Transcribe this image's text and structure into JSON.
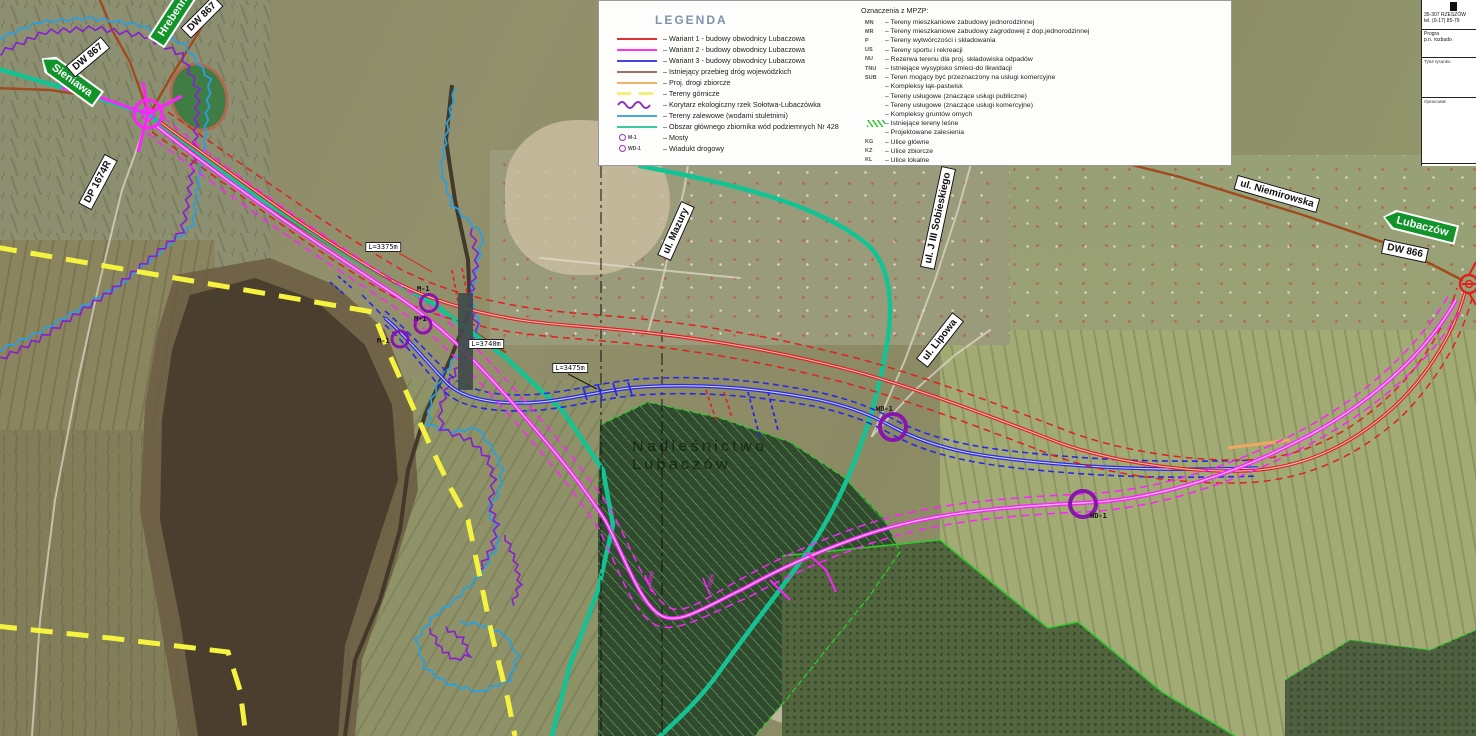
{
  "legend": {
    "title": "LEGENDA",
    "items": [
      {
        "swatch": "line",
        "color": "#e03030",
        "label": "Wariant 1 - budowy obwodnicy Lubaczowa"
      },
      {
        "swatch": "line",
        "color": "#ff30ff",
        "label": "Wariant 2 - budowy obwodnicy Lubaczowa"
      },
      {
        "swatch": "line",
        "color": "#4444e8",
        "label": "Wariant 3 - budowy obwodnicy Lubaczowa"
      },
      {
        "swatch": "line",
        "color": "#9a7263",
        "label": "Istniejący przebieg dróg wojewódzkich"
      },
      {
        "swatch": "line",
        "color": "#eeb268",
        "label": "Proj. drogi zbiorcze"
      },
      {
        "swatch": "dashes",
        "color": "#f4ef7a",
        "label": "Tereny górnicze"
      },
      {
        "swatch": "wavy",
        "color": "#8a2fc9",
        "label": "Korytarz ekologiczny rzek Sołotwa-Lubaczówka"
      },
      {
        "swatch": "line",
        "color": "#49a8de",
        "label": "Tereny zalewowe (wodami stuletnimi)"
      },
      {
        "swatch": "line",
        "color": "#3fc9a1",
        "label": "Obszar głównego zbiornika wód podziemnych Nr 428"
      },
      {
        "swatch": "circle",
        "color": "#9b30c0",
        "code": "M-1",
        "label": "Mosty"
      },
      {
        "swatch": "circle",
        "color": "#9b30c0",
        "code": "WD-1",
        "label": "Wiadukt drogowy"
      }
    ],
    "mpzp": {
      "title": "Oznaczenia z MPZP:",
      "items": [
        {
          "code": "MN",
          "label": "Tereny mieszkaniowe zabudowy jednorodzinnej"
        },
        {
          "code": "MR",
          "label": "Tereny mieszkaniowe zabudowy zagrodowej z dop.jednorodzinnej"
        },
        {
          "code": "P",
          "label": "Tereny wytwórczości i składowania"
        },
        {
          "code": "US",
          "label": "Tereny sportu i rekreacji"
        },
        {
          "code": "NU",
          "label": "Rezerwa terenu dla proj. składowiska odpadów"
        },
        {
          "code": "TNU",
          "label": "Istniejące wysypisko śmieci-do likwidacji"
        },
        {
          "code": "SUB",
          "label": "Teren mogący być przeznaczony na usługi komercyjne"
        },
        {
          "code": "",
          "label": "Kompleksy łąk-pastwisk"
        },
        {
          "code": "",
          "label": "Tereny usługowe (znaczące usługi publiczne)"
        },
        {
          "code": "",
          "label": "Tereny usługowe (znaczące usługi komercyjne)"
        },
        {
          "code": "",
          "label": "Kompleksy gruntów ornych"
        },
        {
          "code": "",
          "swatch": "hatch",
          "label": "Istniejące tereny leśne"
        },
        {
          "code": "",
          "label": "Projektowane zalesienia"
        },
        {
          "code": "KG",
          "label": "Ulice główne"
        },
        {
          "code": "KZ",
          "label": "Ulice zbiorcze"
        },
        {
          "code": "KL",
          "label": "Ulice lokalne"
        }
      ]
    }
  },
  "map": {
    "signs": {
      "sieniawa": "Sieniawa",
      "hrebenne": "Hrebenne",
      "lubaczow": "Lubaczów",
      "dw867_1": "DW 867",
      "dw867_2": "DW 867",
      "dp1674r": "DP 1674R",
      "dw866": "DW 866",
      "ul_niemirowska": "ul. Niemirowska",
      "ul_mazury": "ul. Mazury",
      "ul_lipowa": "ul. Lipowa",
      "ul_sobieskiego": "ul. J III Sobieskiego"
    },
    "length_labels": [
      "L=3375m",
      "L=3740m",
      "L=3475m"
    ],
    "bridge_labels": [
      "M-1",
      "M-1",
      "M-1"
    ],
    "viaduct_labels": [
      "WD-1",
      "WD-1"
    ],
    "forest_label_line1": "Nadleśnictwo",
    "forest_label_line2": "Lubaczów",
    "chainage": [
      "4000",
      "7000"
    ],
    "colors": {
      "variant1": "#e02020",
      "variant2": "#ff22ff",
      "variant3": "#2828e8",
      "existing_road": "#a04a1e",
      "collector_road": "#f0a860",
      "mining": "#f6f340",
      "eco_corridor": "#8822cc",
      "flood": "#28a0e0",
      "aquifer": "#14c394",
      "structures": "#8816ad"
    }
  },
  "titleblock": {
    "address": "35-307 RZESZÓW",
    "phone": "tel. (0-17) 85-79",
    "project_line1": "Progra",
    "project_line2": "p.n. rozbudo",
    "drawing_label": "Tytuł rysunku",
    "author_label": "Opracował"
  }
}
